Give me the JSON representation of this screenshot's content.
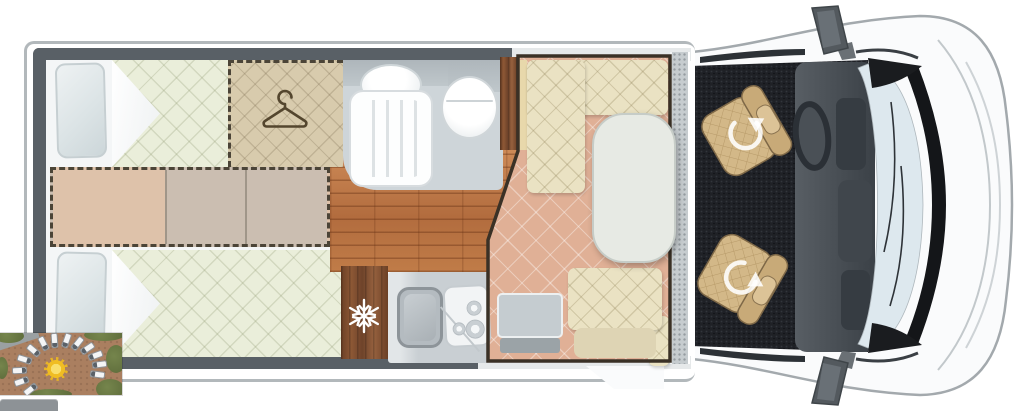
{
  "floorplan": {
    "type": "motorhome-top-view-floorplan",
    "areas": {
      "rear_bedroom": {
        "name": "twin-single-beds",
        "features": [
          "pillow-left-top",
          "pillow-left-bottom",
          "mattress-top",
          "mattress-bottom",
          "fold-down-middle-section-dashed"
        ]
      },
      "wardrobe": {
        "icon": "hanger-icon"
      },
      "bathroom": {
        "features": [
          "washbasin",
          "shower-tray",
          "toilet"
        ]
      },
      "kitchen": {
        "icon": "snowflake-icon",
        "features": [
          "fridge",
          "sink",
          "hob-with-burners"
        ]
      },
      "dinette": {
        "features": [
          "l-shaped-bench",
          "oval-table",
          "single-seat",
          "side-bench"
        ]
      },
      "cab": {
        "seats": 2,
        "icon": "swivel-arrow-icon",
        "features": [
          "driver-swivel-seat",
          "passenger-swivel-seat",
          "dashboard",
          "steering-wheel",
          "windscreen",
          "wing-mirror-top",
          "wing-mirror-bottom"
        ]
      }
    },
    "colors": {
      "wall": "#596066",
      "bodyline": "#b2b8bb",
      "mattress": "#eaeeda",
      "wardrobe": "#d8cbad",
      "dashline": "#4b4437",
      "midpink": "#dec2aa",
      "midgray": "#cbbeb1",
      "bathfloor": "#ced5d9",
      "salmon": "#e0b096",
      "bench": "#eae2c3",
      "table": "#e7eae4",
      "carpet": "#1f2126",
      "seat": "#d3b888",
      "cabbody": "#fafbfc",
      "windscreen": "#dde8ee",
      "dashboard": "#474d53",
      "outline": "#3a3126",
      "sun": "#f0bd23",
      "ground": "#aa7f60",
      "bush": "#5e6c3b",
      "badge": "#8d9296"
    }
  },
  "thumbnail": {
    "type": "aerial-photo-motorhomes-parked-around-sun-logo",
    "sun": {
      "x": 56,
      "y": 36,
      "size": 24
    },
    "vans": [
      {
        "x": 33,
        "y": 17,
        "r": 40
      },
      {
        "x": 24,
        "y": 26,
        "r": 17
      },
      {
        "x": 19,
        "y": 37,
        "r": -2
      },
      {
        "x": 21,
        "y": 48,
        "r": -19
      },
      {
        "x": 30,
        "y": 56,
        "r": -38
      },
      {
        "x": 43,
        "y": 10,
        "r": 63
      },
      {
        "x": 54,
        "y": 7,
        "r": 86
      },
      {
        "x": 66,
        "y": 7,
        "r": 109
      },
      {
        "x": 77,
        "y": 10,
        "r": 129
      },
      {
        "x": 87,
        "y": 15,
        "r": 146
      },
      {
        "x": 95,
        "y": 22,
        "r": 160
      },
      {
        "x": 99,
        "y": 31,
        "r": 173
      },
      {
        "x": 97,
        "y": 41,
        "r": 187
      }
    ]
  },
  "badge": {
    "visible": true
  }
}
